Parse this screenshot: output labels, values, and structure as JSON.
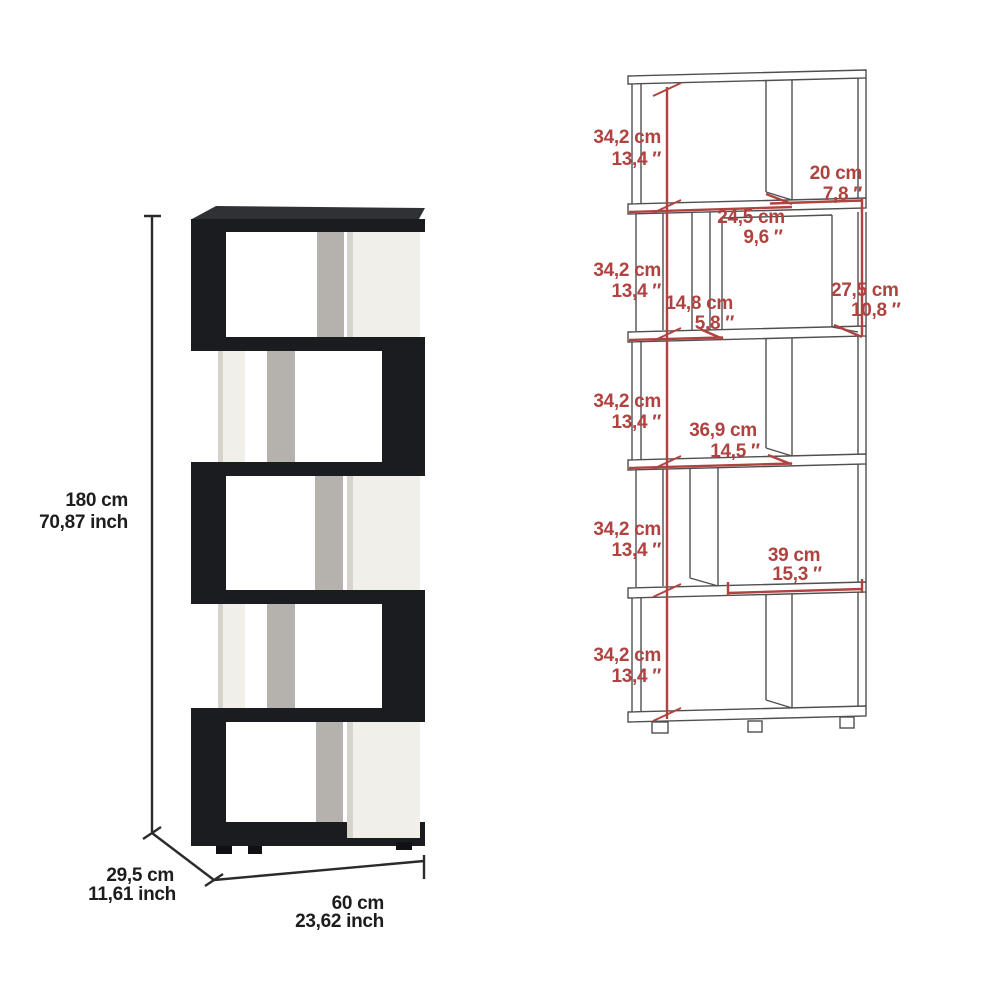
{
  "product_diagram": {
    "left_view": {
      "height_cm": "180 cm",
      "height_inch": "70,87 inch",
      "depth_cm": "29,5 cm",
      "depth_inch": "11,61 inch",
      "width_cm": "60 cm",
      "width_inch": "23,62 inch"
    },
    "right_view": {
      "tier_heights": [
        {
          "cm": "34,2 cm",
          "inch": "13,4 ″"
        },
        {
          "cm": "34,2 cm",
          "inch": "13,4 ″"
        },
        {
          "cm": "34,2 cm",
          "inch": "13,4 ″"
        },
        {
          "cm": "34,2 cm",
          "inch": "13,4 ″"
        },
        {
          "cm": "34,2 cm",
          "inch": "13,4 ″"
        }
      ],
      "top_opening": {
        "cm": "20 cm",
        "inch": "7,8 ″"
      },
      "cube_width": {
        "cm": "24,5 cm",
        "inch": "9,6 ″"
      },
      "side_gap": {
        "cm": "14,8 cm",
        "inch": "5,8 ″"
      },
      "cube_height": {
        "cm": "27,5 cm",
        "inch": "10,8 ″"
      },
      "middle_opening": {
        "cm": "36,9 cm",
        "inch": "14,5 ″"
      },
      "lower_opening": {
        "cm": "39 cm",
        "inch": "15,3 ″"
      }
    },
    "colors": {
      "dimension_red": "#b04340",
      "drawing_line": "#4f4f4f",
      "panel_black": "#1b1c20",
      "panel_white": "#f1efe9",
      "panel_gray": "#b5b2ad",
      "label_black": "#1d1d1f"
    }
  }
}
